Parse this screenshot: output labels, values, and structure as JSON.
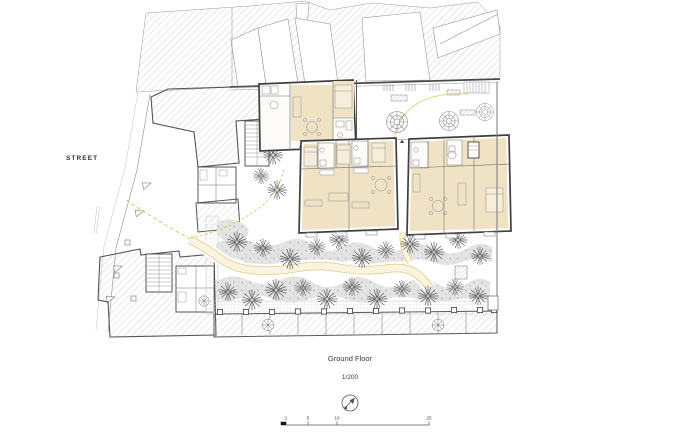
{
  "plan": {
    "street_label": "STREET",
    "caption": {
      "title": "Ground Floor",
      "scale": "1/200"
    },
    "scale_bar": {
      "tick_labels": [
        "1",
        "5",
        "10",
        "25"
      ]
    },
    "north_indicator": "north-arrow",
    "colors": {
      "wall": "#3f3f3f",
      "hatch_line": "#aaaaaa",
      "room_fill": "#f0e3c5",
      "furniture_fill": "#f6eedb",
      "planting_fill": "#e4e4e4",
      "tree_stroke": "#5a5a5a",
      "court_tree_stroke": "#8a8a8a",
      "path_fill": "#faf3dd",
      "path_edge": "#dcc98c",
      "accent_yellow": "#dfc257"
    }
  }
}
